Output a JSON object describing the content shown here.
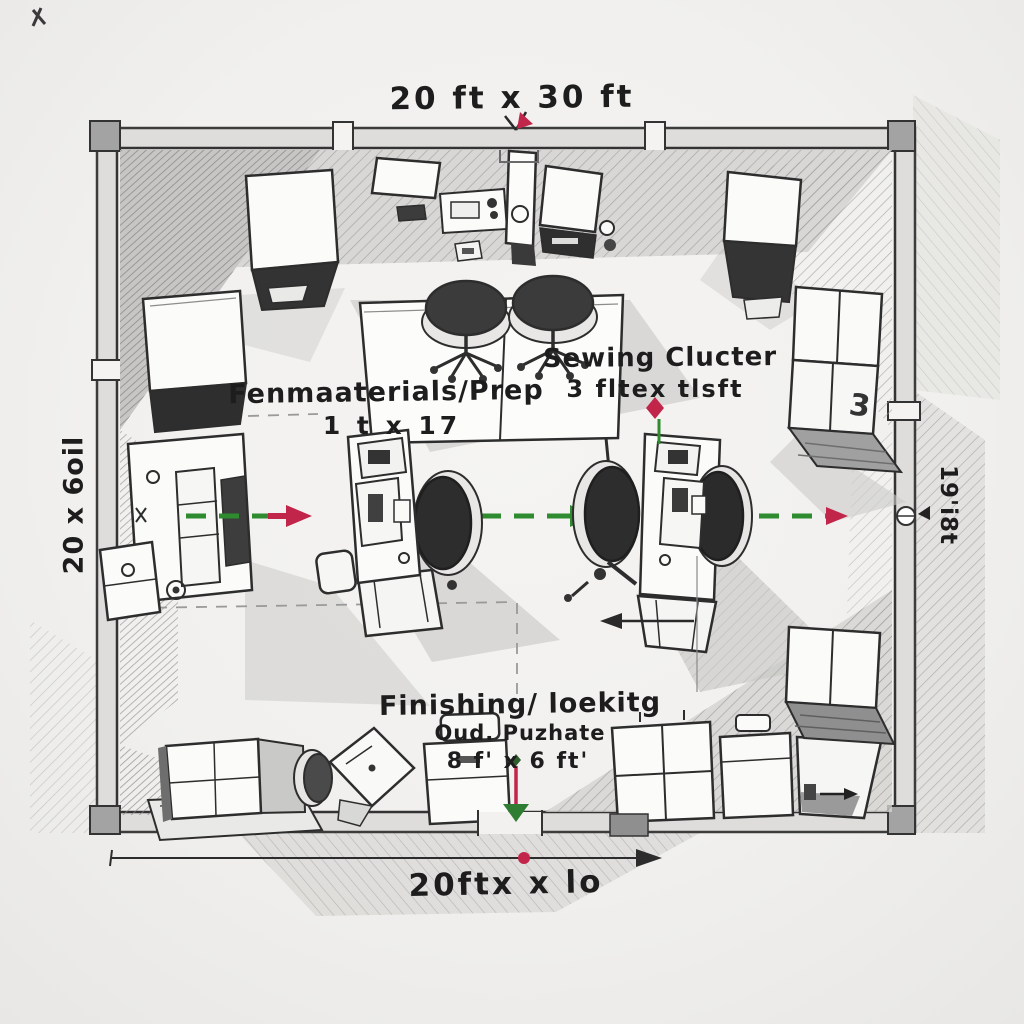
{
  "palette": {
    "paper": "#f1f0ee",
    "ink": "#2b2b2b",
    "pencil_gray": "#9b9b9b",
    "flow_green": "#2f8b2f",
    "accent_red": "#c2254a"
  },
  "dimensions": {
    "top": "20 ft x 30 ft",
    "bottom": "20ftx x lo",
    "left": "20 x 6oil",
    "right": "19'i8t"
  },
  "zones": {
    "materials": {
      "title": "Fenmaaterials/Prep",
      "size": "1 t x 17"
    },
    "sewing": {
      "title": "Sewing Clucter",
      "size": "3 fltex tlsft"
    },
    "finishing": {
      "title": "Finishing/ loekitg",
      "subtitle": "Oud. Puzhate",
      "size": "8 f' x 6 ft'"
    }
  },
  "marks": {
    "box_count": "3"
  }
}
